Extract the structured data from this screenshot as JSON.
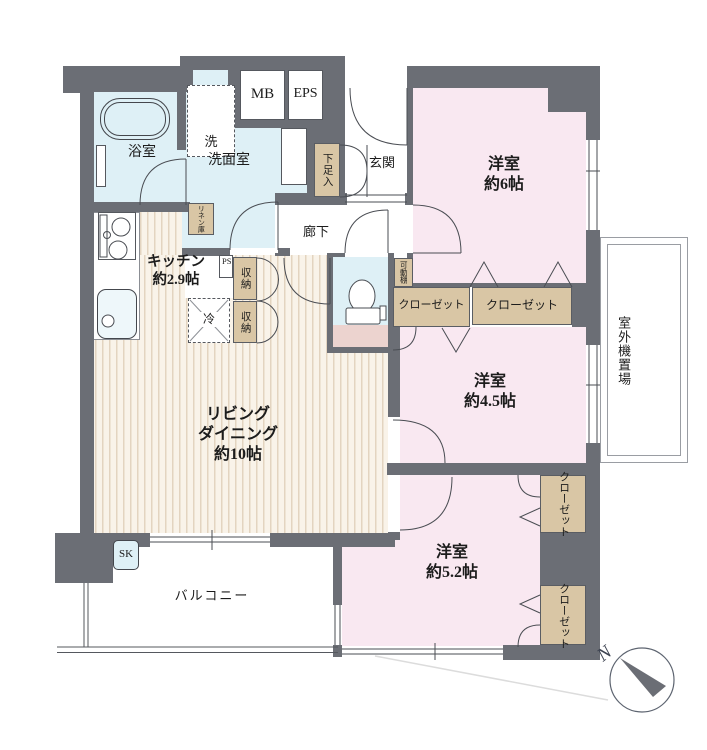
{
  "labels": {
    "bathroom": "浴室",
    "washroom": "洗面室",
    "washer": "洗",
    "mb": "MB",
    "eps": "EPS",
    "entrance": "玄関",
    "shoe_cabinet": "下足入",
    "corridor": "廊下",
    "kitchen_name": "キッチン",
    "kitchen_size": "約2.9帖",
    "linen": "リネン庫",
    "ps": "PS",
    "storage": "収納",
    "fridge": "冷",
    "movable_shelf": "可動棚",
    "closet": "クローゼット",
    "living_1": "リビング",
    "living_2": "ダイニング",
    "living_3": "約10帖",
    "room6_name": "洋室",
    "room6_size": "約6帖",
    "room45_name": "洋室",
    "room45_size": "約4.5帖",
    "room52_name": "洋室",
    "room52_size": "約5.2帖",
    "balcony": "バルコニー",
    "outdoor_unit": "室外機置場",
    "slop_sink": "SK",
    "north": "N"
  },
  "colors": {
    "wall": "#6b6e75",
    "room_pink": "#f9e8f1",
    "water_blue": "#def0f6",
    "closet_tan": "#d9c6a5",
    "floor_stripe": "#e3d4c0",
    "toilet_floor": "#ecd3cf"
  }
}
